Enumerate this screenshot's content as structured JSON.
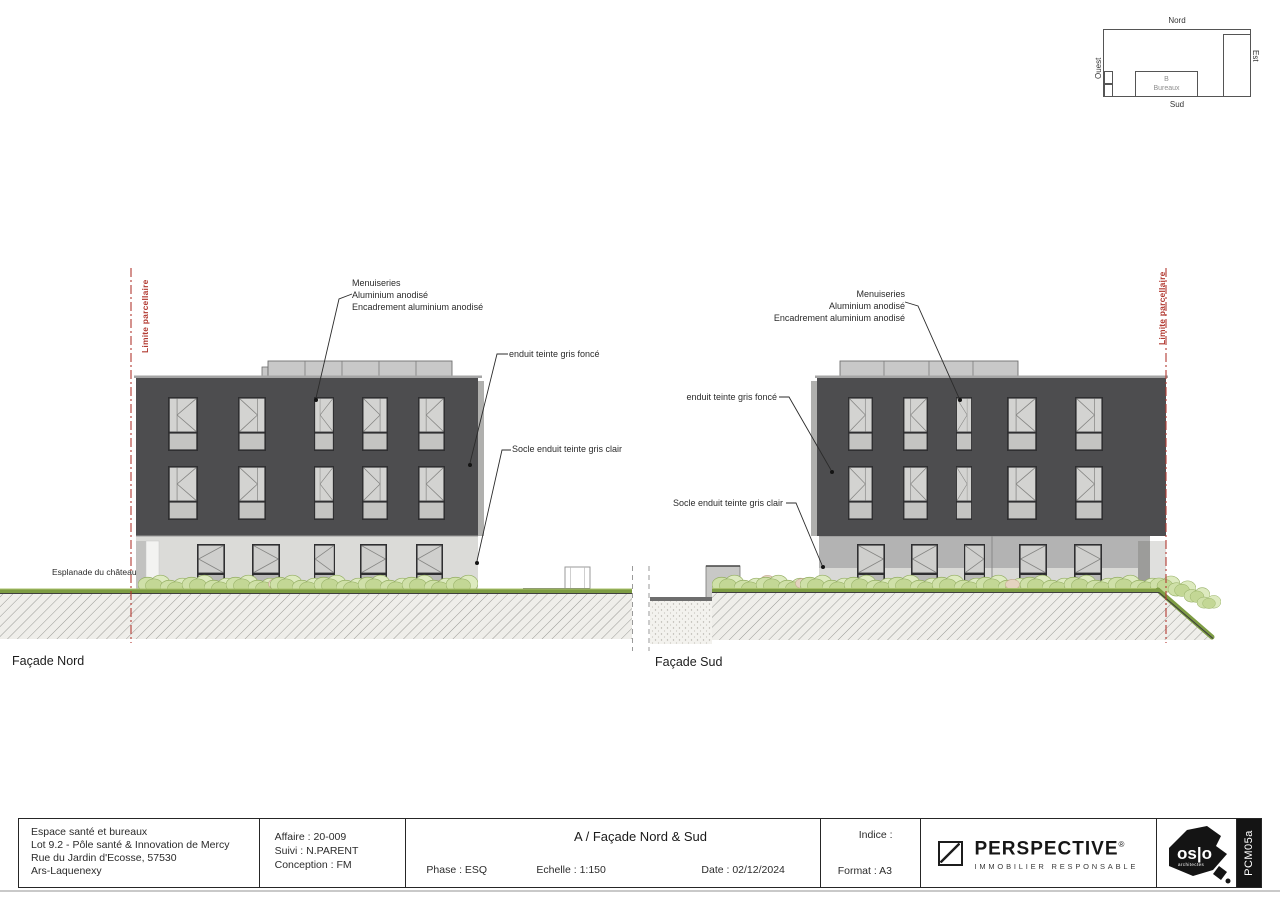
{
  "key_plan": {
    "north_label": "Nord",
    "south_label": "Sud",
    "east_label": "Est",
    "west_label": "Ouest",
    "building_letter": "B",
    "building_name": "Bureaux"
  },
  "elevation_north": {
    "label": "Façade Nord",
    "limit_label": "Limite parcellaire",
    "esplanade_label": "Esplanade du château",
    "menuiseries_lines": [
      "Menuiseries",
      "Aluminium anodisé",
      "Encadrement aluminium anodisé"
    ],
    "enduit_label": "enduit teinte gris foncé",
    "socle_label": "Socle enduit teinte gris clair"
  },
  "elevation_south": {
    "label": "Façade Sud",
    "limit_label": "Limite parcellaire",
    "menuiseries_lines": [
      "Menuiseries",
      "Aluminium anodisé",
      "Encadrement aluminium anodisé"
    ],
    "enduit_label": "enduit teinte gris foncé",
    "socle_label": "Socle enduit teinte gris clair"
  },
  "title_block": {
    "project_lines": [
      "Espace santé et bureaux",
      "Lot 9.2 - Pôle santé & Innovation de Mercy",
      "Rue du Jardin d'Ecosse, 57530",
      "Ars-Laquenexy"
    ],
    "affaire": "Affaire : 20-009",
    "suivi": "Suivi : N.PARENT",
    "conception": "Conception : FM",
    "drawing_title": "A / Façade Nord & Sud",
    "indice": "Indice :",
    "phase": "Phase : ESQ",
    "echelle": "Echelle : 1:150",
    "date": "Date : 02/12/2024",
    "format": "Format : A3",
    "perspective_name": "PERSPECTIVE",
    "perspective_reg": "®",
    "perspective_tagline": "IMMOBILIER RESPONSABLE",
    "oslo_name": "os|o",
    "oslo_sub": "architectes",
    "sheet_code": "PCM05a"
  },
  "colors": {
    "facade_dark": "#4d4d4f",
    "socle_light": "#dbdbd8",
    "socle_mid": "#b3b3b3",
    "roof_band": "#c8c8c8",
    "limit_red": "#b23a31",
    "hedge_green": "#cfe0a8",
    "grass_green": "#7d9c43"
  }
}
